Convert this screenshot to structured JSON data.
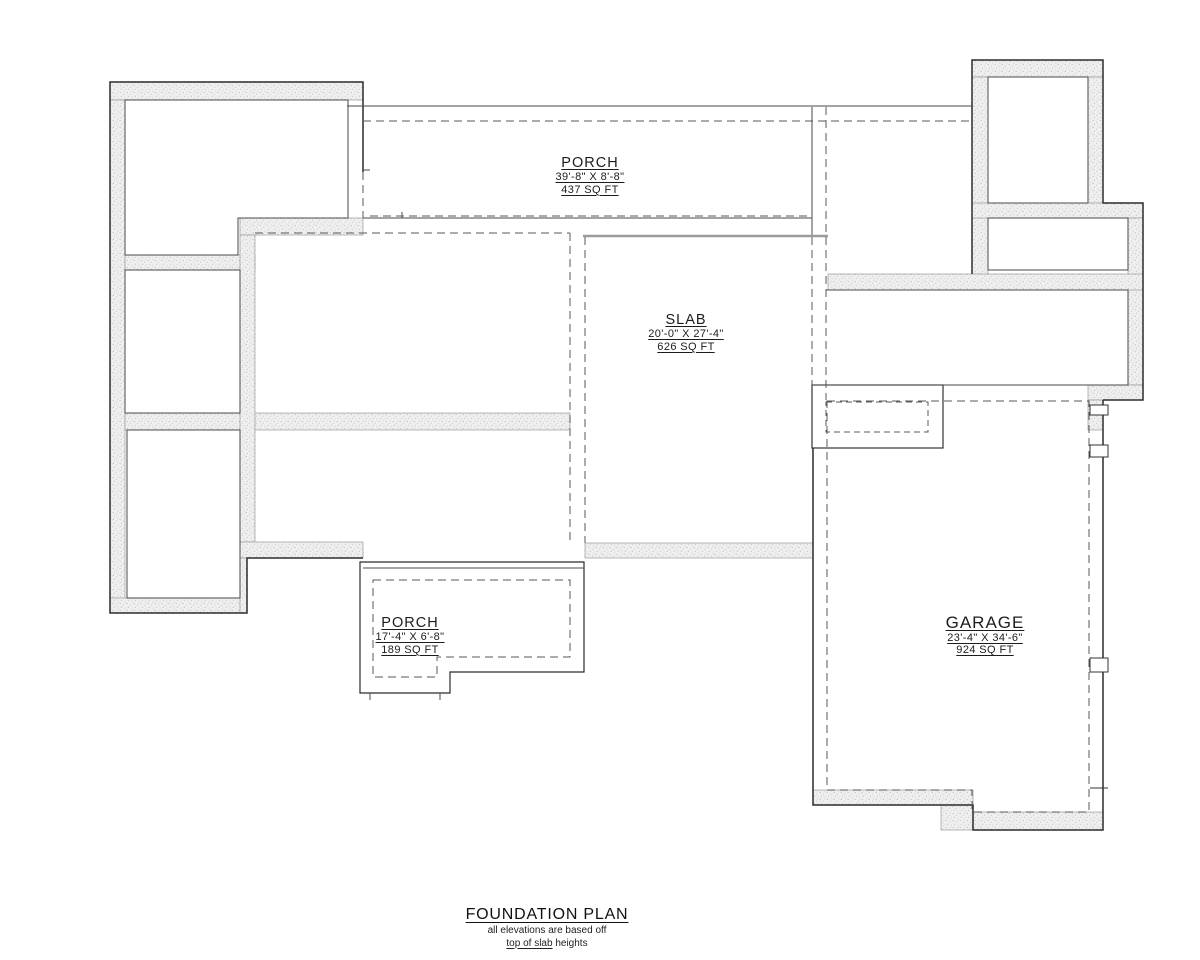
{
  "plan_labels": {
    "porch_top": {
      "name": "PORCH",
      "dimensions": "39'-8\" X 8'-8\"",
      "area": "437 SQ FT"
    },
    "slab": {
      "name": "SLAB",
      "dimensions": "20'-0\" X 27'-4\"",
      "area": "626 SQ FT"
    },
    "porch_bottom": {
      "name": "PORCH",
      "dimensions": "17'-4\" X 6'-8\"",
      "area": "189 SQ FT"
    },
    "garage": {
      "name": "GARAGE",
      "dimensions": "23'-4\" X 34'-6\"",
      "area": "924 SQ FT"
    }
  },
  "title_block": {
    "title": "FOUNDATION PLAN",
    "note_line1": "all elevations are based off",
    "note_underlined": "top of slab",
    "note_rest": " heights"
  },
  "colors": {
    "background": "#ffffff",
    "wall_fill": "#efefef",
    "wall_speckle": "#c6c6c6",
    "outline_dark": "#2b2b2b",
    "line_mid": "#4a4a4a",
    "dash": "#5a5a5a",
    "slab_edge": "#9b9b9b",
    "text": "#1c1c1c"
  }
}
